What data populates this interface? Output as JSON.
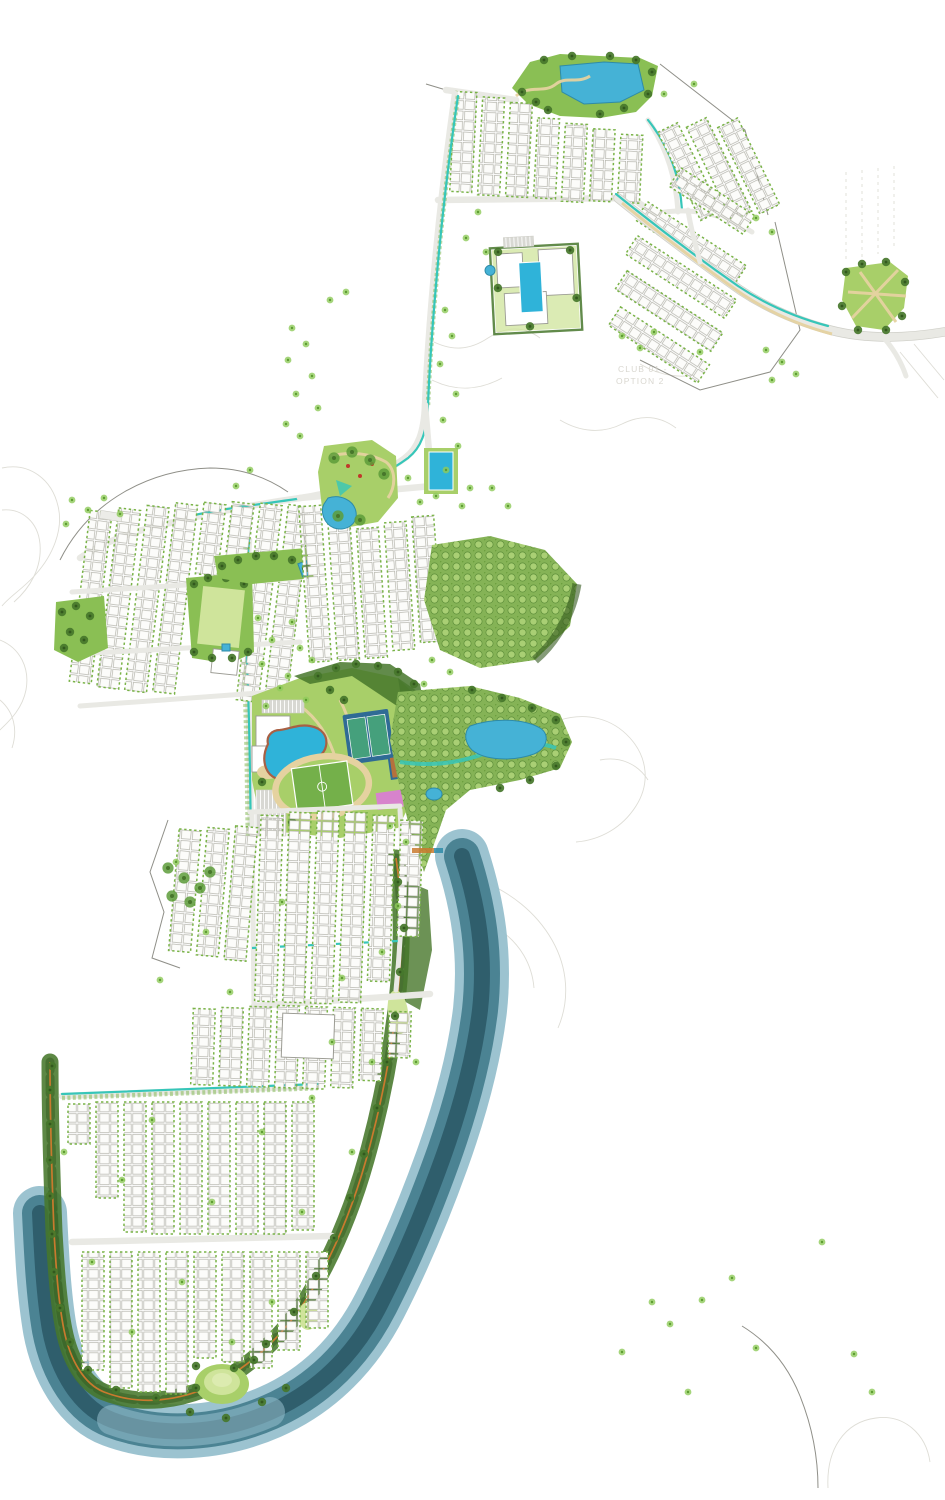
{
  "labels": {
    "club_area_line1": "CLUB 01 -",
    "club_area_line2": "OPTION 2"
  },
  "colors": {
    "paper": "#ffffff",
    "contour": "#deddd6",
    "boundary": "#8f8f88",
    "road_fill": "#e9e9e4",
    "road_casing": "#cfcfc8",
    "lot_fill": "#fcfcfa",
    "lot_stroke": "#b2b2a9",
    "verge_green": "#79b347",
    "canal_teal": "#36c6b9",
    "path_tan": "#e5d2a0",
    "path_orange": "#c97a2e",
    "tree_light": "#8ecb5a",
    "tree_core": "#5d9c31",
    "tree_dark": "#47772b",
    "tree_dark_core": "#33591e",
    "lawn_light": "#cfe49b",
    "lawn_green": "#a8cf69",
    "field_green": "#74b04a",
    "park_green": "#8abf54",
    "forest_base": "#85b356",
    "forest_ring": "#a9cf74",
    "forest_ring_edge": "#5e8f3a",
    "pond_blue": "#45b2d6",
    "pond_edge": "#2e8ba8",
    "pool_blue": "#2fb3d9",
    "river_deep": "#2c5a68",
    "river_mid": "#47808f",
    "river_light": "#97c0cd",
    "court_outer": "#2f6b95",
    "court_inner": "#45a07c",
    "bball_orange": "#b5713d",
    "court_pink": "#d783cc",
    "building_stroke": "#9b9b93",
    "parking_gray": "#d8d8d3",
    "deck_terracotta": "#a86044",
    "faint_text": "#d9d7d0"
  }
}
